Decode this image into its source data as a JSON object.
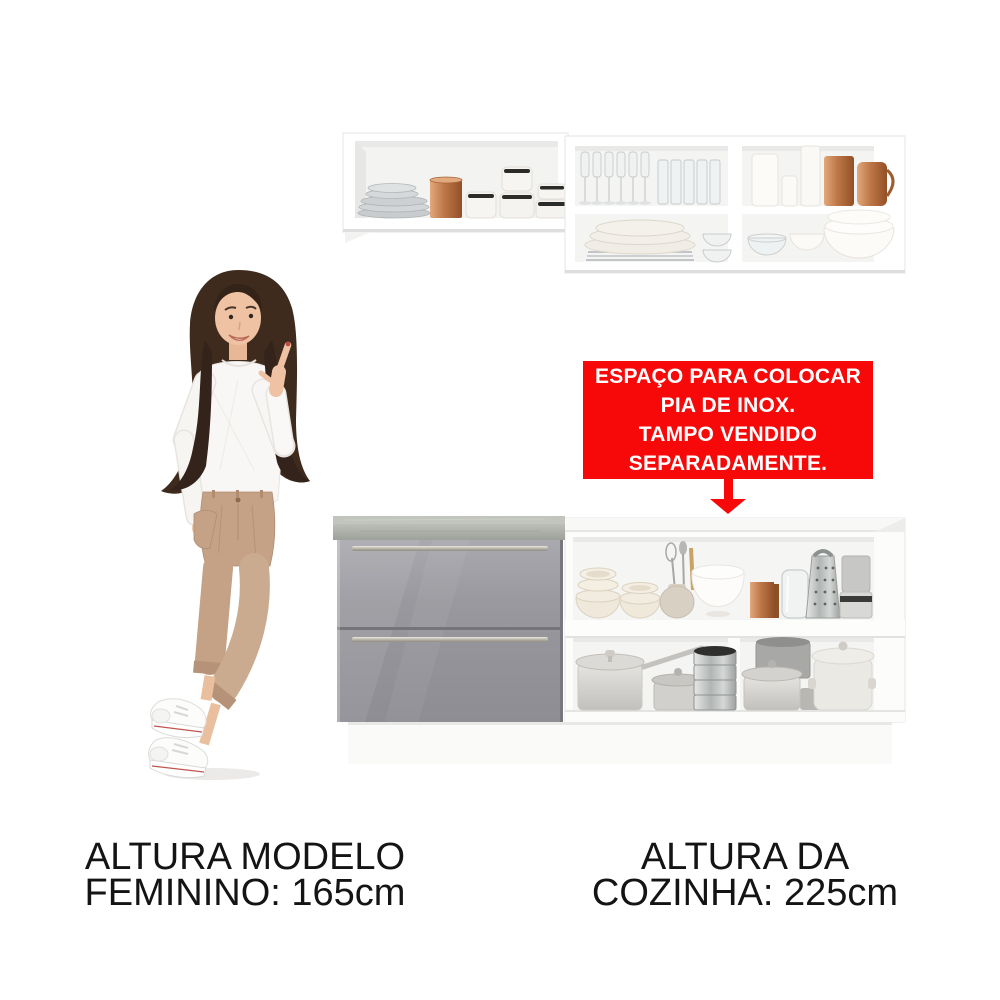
{
  "annotation_box": {
    "background_color": "#f80909",
    "text_color": "#ffffff",
    "lines": [
      "ESPAÇO PARA COLOCAR",
      "PIA DE INOX.",
      "TAMPO VENDIDO",
      "SEPARADAMENTE."
    ]
  },
  "labels": {
    "model_height_line1": "ALTURA MODELO",
    "model_height_line2": "FEMININO: 165cm",
    "kitchen_height_line1": "ALTURA DA",
    "kitchen_height_line2": "COZINHA: 225cm"
  },
  "colors": {
    "annotation_red": "#f80909",
    "drawer_gray": "#97979d",
    "countertop_concrete": "#adb0a8",
    "copper_accent": "#bf7a4c",
    "cabinet_white": "#ffffff",
    "label_black": "#141414"
  }
}
